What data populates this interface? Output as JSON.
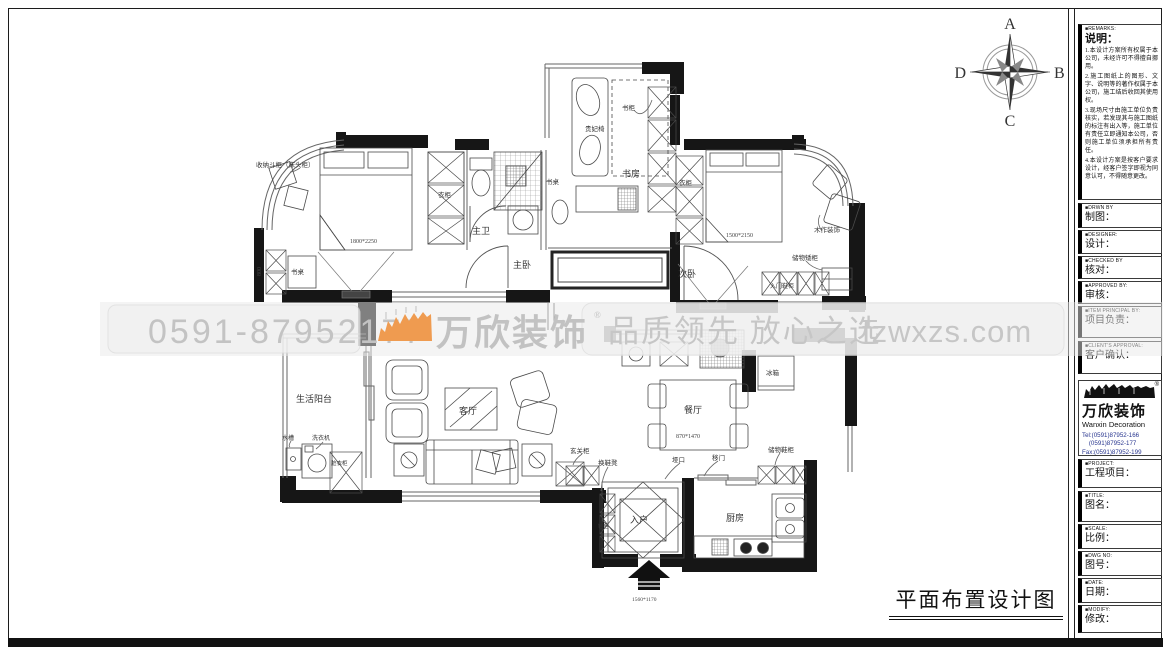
{
  "page": {
    "drawing_title": "平面布置设计图"
  },
  "compass": {
    "north": "A",
    "east": "B",
    "south": "C",
    "west": "D"
  },
  "watermark": {
    "phone": "0591-87952177",
    "brand": "万欣装饰",
    "registered": "®",
    "slogan": "品质领先 放心之选",
    "website": "fzwxzs.com",
    "orange": "#ef9b50",
    "gray": "#c3c3c3"
  },
  "titleblock": {
    "remarks": {
      "en": "■REMARKS:",
      "cn": "说明：",
      "items": [
        "1.本设计方案所有权属于本公司，未经许可不得擅自挪用。",
        "2.施工图纸上的图形、文字、说明等的著作权属于本公司，施工结后收回其使用权。",
        "3.现场尺寸由施工单位负责核实，若发现其与施工图纸的标注有出入等，施工单位有责任立即通知本公司，否则施工单位须承担所有责任。",
        "4.本设计方案是按客户要求设计，经客户签字即视为同意认可，不得随意更改。"
      ]
    },
    "rows": [
      {
        "en": "■DRWN BY",
        "cn": "制图："
      },
      {
        "en": "■DESIGNER:",
        "cn": "设计："
      },
      {
        "en": "■CHECKED BY",
        "cn": "核对："
      },
      {
        "en": "■APPROVED BY:",
        "cn": "审核："
      },
      {
        "en": "■ITEM PRINCIPAL BY:",
        "cn": "项目负责："
      },
      {
        "en": "■CLIENT'S APPROVAL:",
        "cn": "客户确认："
      }
    ],
    "company": {
      "name": "万欣装饰",
      "name_en": "Wanxin Decoration",
      "registered": "®",
      "tel1": "Tel:(0591)87952-166",
      "tel2": "    (0591)87952-177",
      "fax": "Fax:(0591)87952-199",
      "web": "Web:WWW.fzwxzs.com"
    },
    "rows2": [
      {
        "en": "■PROJECT:",
        "cn": "工程项目："
      },
      {
        "en": "■TITLE:",
        "cn": "图名："
      },
      {
        "en": "■SCALE:",
        "cn": "比例："
      },
      {
        "en": "■DWG NO:",
        "cn": "图号："
      },
      {
        "en": "■DATE:",
        "cn": "日期："
      },
      {
        "en": "■MODIFY:",
        "cn": "修改："
      }
    ]
  },
  "plan": {
    "rooms": {
      "master_bedroom": "主卧",
      "master_bath": "主卫",
      "study": "书房",
      "second_bedroom": "次卧",
      "living": "客厅",
      "dining": "餐厅",
      "kitchen": "厨房",
      "entry": "入户",
      "balcony": "生活阳台"
    },
    "labels": {
      "bedside_cabinet": "收纳斗柜（床头柜）",
      "wardrobe_1": "衣柜",
      "wardrobe_2": "衣柜",
      "bookcase": "书柜",
      "desk_1": "书桌",
      "desk_2": "书桌",
      "chaise": "贵妃椅",
      "wood_decor": "木作装饰",
      "low_cabinet": "储物矮柜",
      "entry_shoe_cabinet": "入门鞋柜",
      "fridge": "冰箱",
      "washer": "洗衣机",
      "sink": "水槽",
      "laundry_cabinet": "脏衣柜",
      "shoe_bench": "换鞋凳",
      "opening": "垭口",
      "sliding_door": "移门",
      "storage_shoe_cabinet": "储物鞋柜",
      "hallway_cabinet": "玄关柜",
      "shoe_cabinet": "鞋柜"
    },
    "dims": {
      "bed_master": "1800*2250",
      "bed_second": "1500*2150",
      "dining_table": "870*1470",
      "niche": "800",
      "entry_door": "1560*1170"
    }
  }
}
